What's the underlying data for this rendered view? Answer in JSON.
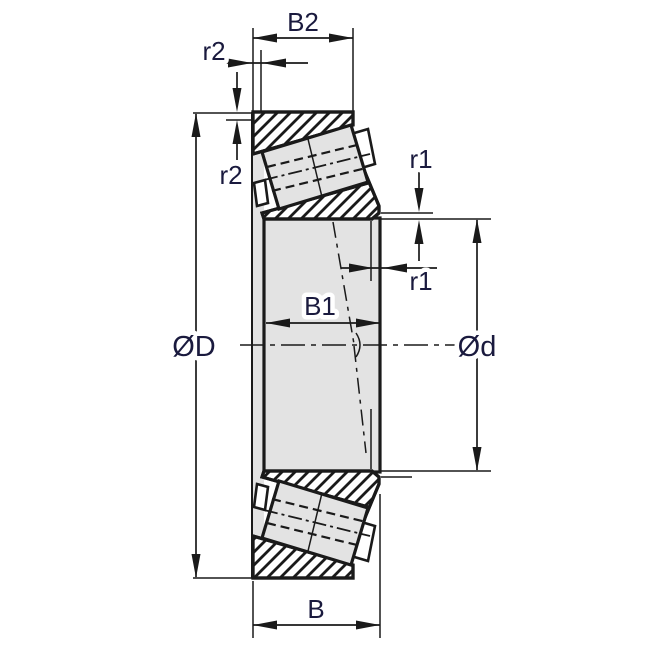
{
  "drawing_type": "technical-drawing",
  "subject": "Tapered roller bearing cross-section with dimension annotations",
  "dimensions": {
    "cup_width": {
      "label": "B2"
    },
    "cone_width": {
      "label": "B1"
    },
    "total_width": {
      "label": "B"
    },
    "outer_diameter": {
      "label": "ØD"
    },
    "bore_diameter": {
      "label": "Ød"
    },
    "cone_back_chamfer": {
      "label": "r1"
    },
    "cup_front_chamfer": {
      "label": "r2"
    }
  },
  "colors": {
    "background": "#ffffff",
    "line": "#1a1a1a",
    "label": "#1a1a3e",
    "section_gray": "#e3e3e3"
  }
}
